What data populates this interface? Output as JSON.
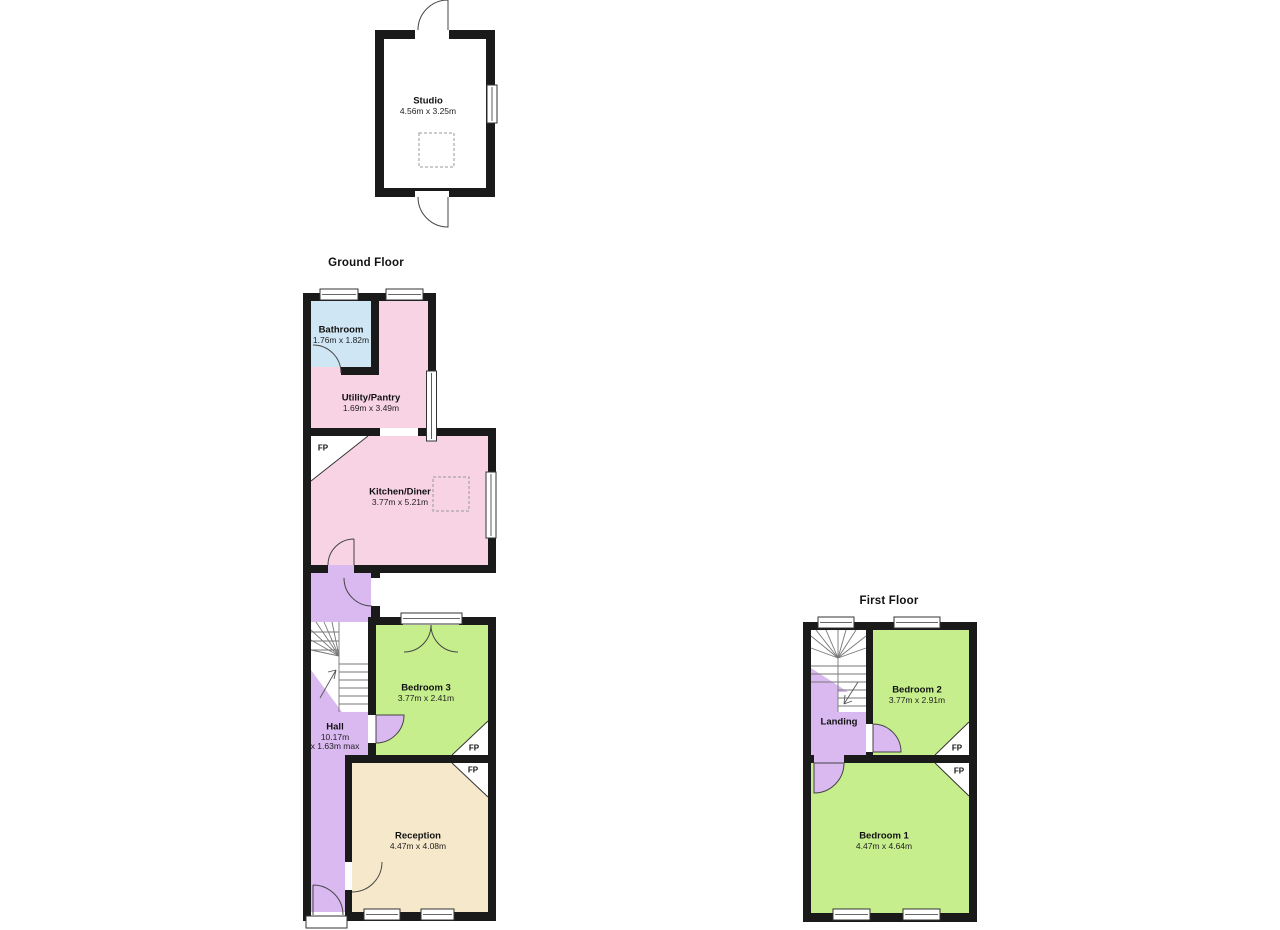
{
  "titles": {
    "ground_floor": "Ground Floor",
    "first_floor": "First Floor"
  },
  "rooms": {
    "studio": {
      "name": "Studio",
      "dims": "4.56m x 3.25m"
    },
    "bathroom": {
      "name": "Bathroom",
      "dims": "1.76m x 1.82m"
    },
    "utility": {
      "name": "Utility/Pantry",
      "dims": "1.69m x 3.49m"
    },
    "kitchen": {
      "name": "Kitchen/Diner",
      "dims": "3.77m x 5.21m"
    },
    "hall": {
      "name": "Hall",
      "dims_line1": "10.17m",
      "dims_line2": "x 1.63m max"
    },
    "bedroom3": {
      "name": "Bedroom 3",
      "dims": "3.77m x 2.41m"
    },
    "reception": {
      "name": "Reception",
      "dims": "4.47m x 4.08m"
    },
    "landing": {
      "name": "Landing"
    },
    "bedroom2": {
      "name": "Bedroom 2",
      "dims": "3.77m x 2.91m"
    },
    "bedroom1": {
      "name": "Bedroom 1",
      "dims": "4.47m x 4.64m"
    }
  },
  "annotations": {
    "fireplace": "FP"
  },
  "colors": {
    "wall": "#1a1a1a",
    "pink": "#f8d3e4",
    "blue": "#cfe6f4",
    "purple": "#d9b9f0",
    "green": "#c6ee8c",
    "cream": "#f6e8cb",
    "white": "#ffffff"
  }
}
